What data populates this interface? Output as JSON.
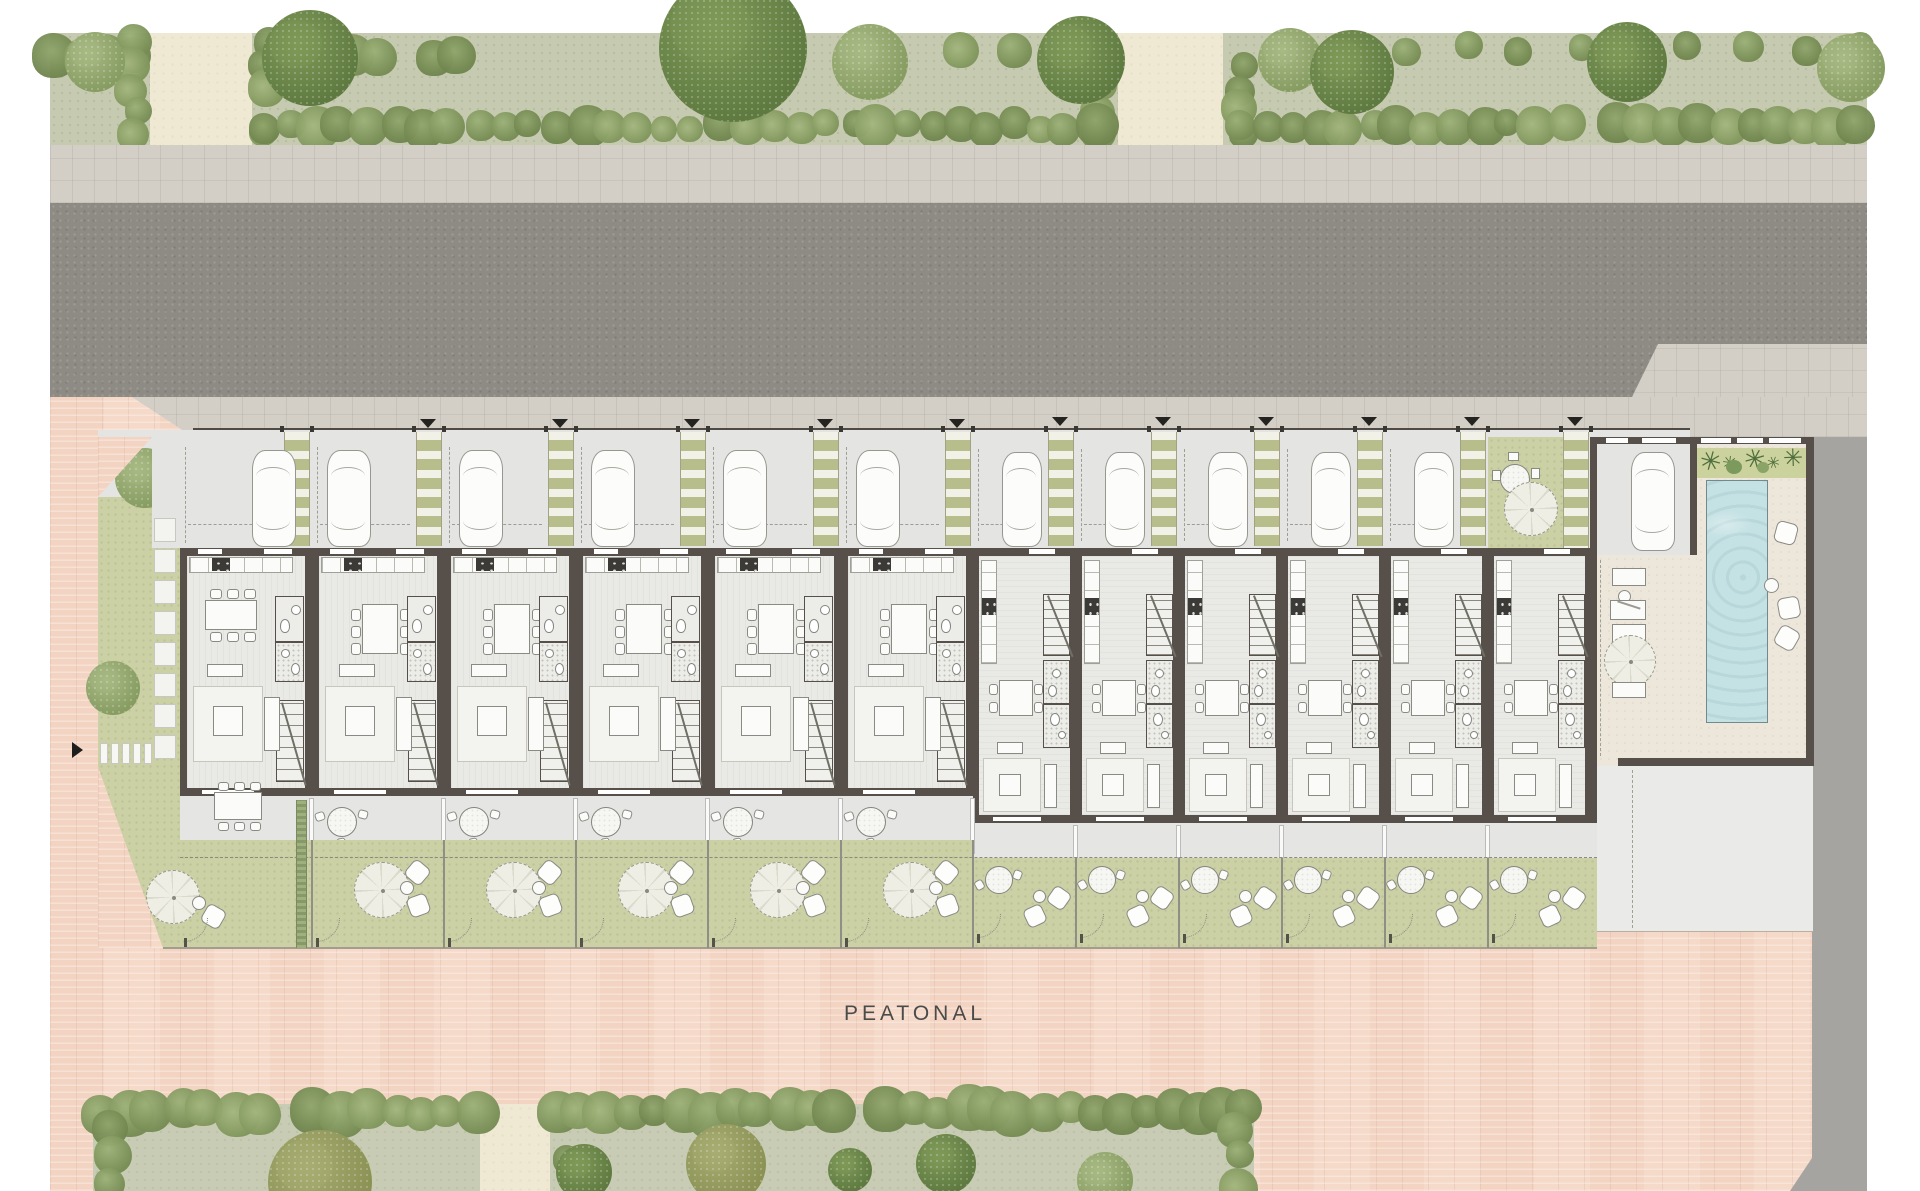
{
  "pedestrian_zone": {
    "label": "PEATONAL"
  },
  "site": {
    "house_units": [
      {
        "id": 1,
        "type": "wide"
      },
      {
        "id": 2,
        "type": "wide"
      },
      {
        "id": 3,
        "type": "wide"
      },
      {
        "id": 4,
        "type": "wide"
      },
      {
        "id": 5,
        "type": "wide"
      },
      {
        "id": 6,
        "type": "wide"
      },
      {
        "id": 7,
        "type": "narrow"
      },
      {
        "id": 8,
        "type": "narrow"
      },
      {
        "id": 9,
        "type": "narrow"
      },
      {
        "id": 10,
        "type": "narrow"
      },
      {
        "id": 11,
        "type": "narrow"
      },
      {
        "id": 12,
        "type": "narrow"
      }
    ],
    "counts": {
      "parked_cars": 12,
      "grass_paver_strips": 12,
      "driveway_arrows": 11,
      "pools": 1,
      "garden_parasols": 14
    }
  },
  "colors": {
    "pink_paving": "#f5d9c9",
    "asphalt_road": "#8e8b85",
    "sidewalk": "#d3cfc7",
    "site_concrete": "#e4e4e2",
    "house_wall": "#57504a",
    "house_floor": "#e9e9e6",
    "garden_green": "#ccd0a5",
    "landscape_green": "#c6cab0",
    "hedge_green": "#7b9158",
    "paver_grass": "#b7bd8b",
    "pool_water": "#c4e1e3",
    "pool_deck": "#ede6da",
    "palm_green": "#4e6f3d",
    "gray_area": "#a5a4a1",
    "path_beige": "#efe9d4",
    "label_text": "#4b4b49",
    "arrow_black": "#24231f"
  }
}
